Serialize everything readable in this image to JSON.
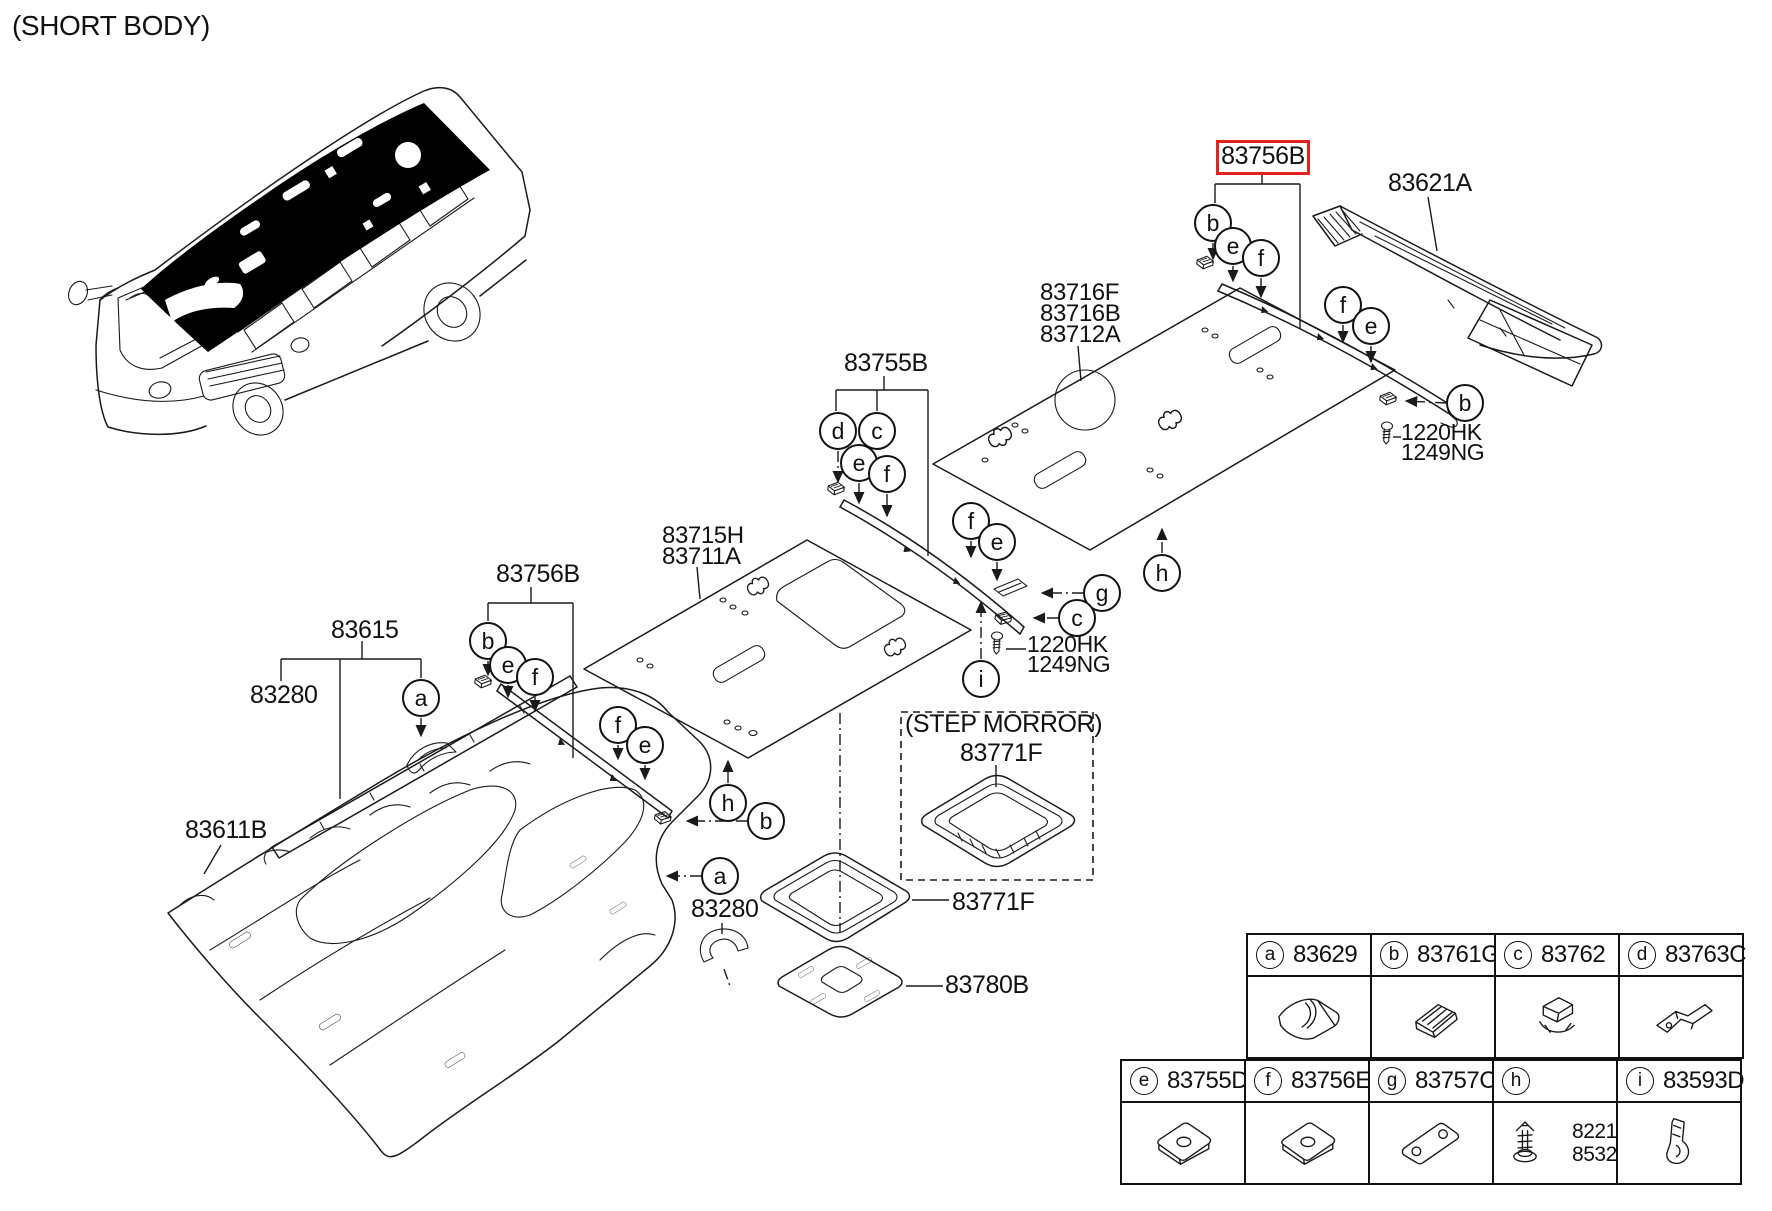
{
  "title": "(SHORT BODY)",
  "colors": {
    "line": "#1a1a1a",
    "highlight": "#e0231c",
    "background": "#ffffff"
  },
  "labels": [
    {
      "name": "label-short-body",
      "text": "(SHORT BODY)",
      "x": 12,
      "y": 12,
      "fs": 28,
      "interactable": false
    },
    {
      "name": "part-label-83756b-highlighted",
      "text": "83756B",
      "x": 1216,
      "y": 140,
      "w": 88,
      "variant": "boxed",
      "interactable": true
    },
    {
      "name": "part-label-83621a",
      "text": "83621A",
      "x": 1388,
      "y": 171,
      "interactable": true
    },
    {
      "name": "part-label-83716f-83716b-83712a",
      "text": "83716F\n83716B\n83712A",
      "x": 1040,
      "y": 282,
      "fs": 24,
      "lh": 21,
      "interactable": true
    },
    {
      "name": "part-label-83755b",
      "text": "83755B",
      "x": 844,
      "y": 351,
      "interactable": true
    },
    {
      "name": "part-label-1220hk-1249ng-right",
      "text": "1220HK\n1249NG",
      "x": 1401,
      "y": 422,
      "fs": 23,
      "lh": 20,
      "interactable": true
    },
    {
      "name": "part-label-83715h-83711a",
      "text": "83715H\n83711A",
      "x": 662,
      "y": 525,
      "fs": 24,
      "lh": 21,
      "interactable": true
    },
    {
      "name": "part-label-83756b-left",
      "text": "83756B",
      "x": 496,
      "y": 562,
      "interactable": true
    },
    {
      "name": "part-label-83615",
      "text": "83615",
      "x": 331,
      "y": 618,
      "interactable": true
    },
    {
      "name": "part-label-83280-front",
      "text": "83280",
      "x": 250,
      "y": 683,
      "interactable": true
    },
    {
      "name": "part-label-1220hk-1249ng-center",
      "text": "1220HK\n1249NG",
      "x": 1027,
      "y": 634,
      "fs": 23,
      "lh": 20,
      "interactable": true
    },
    {
      "name": "label-step-morror",
      "text": "(STEP MORROR)",
      "x": 905,
      "y": 712,
      "interactable": false
    },
    {
      "name": "part-label-83771f-step",
      "text": "83771F",
      "x": 960,
      "y": 741,
      "interactable": true
    },
    {
      "name": "part-label-83611b",
      "text": "83611B",
      "x": 185,
      "y": 818,
      "interactable": true
    },
    {
      "name": "part-label-83771f",
      "text": "83771F",
      "x": 952,
      "y": 890,
      "interactable": true
    },
    {
      "name": "part-label-83280-center",
      "text": "83280",
      "x": 691,
      "y": 897,
      "interactable": true
    },
    {
      "name": "part-label-83780b",
      "text": "83780B",
      "x": 945,
      "y": 973,
      "interactable": true
    }
  ],
  "callouts": [
    {
      "letter": "b",
      "x": 1213,
      "y": 223
    },
    {
      "letter": "e",
      "x": 1233,
      "y": 246
    },
    {
      "letter": "f",
      "x": 1261,
      "y": 258
    },
    {
      "letter": "f",
      "x": 1343,
      "y": 305
    },
    {
      "letter": "e",
      "x": 1371,
      "y": 326
    },
    {
      "letter": "b",
      "x": 1465,
      "y": 403
    },
    {
      "letter": "d",
      "x": 838,
      "y": 431
    },
    {
      "letter": "c",
      "x": 877,
      "y": 431
    },
    {
      "letter": "e",
      "x": 859,
      "y": 463
    },
    {
      "letter": "f",
      "x": 887,
      "y": 474
    },
    {
      "letter": "f",
      "x": 971,
      "y": 521
    },
    {
      "letter": "e",
      "x": 997,
      "y": 542
    },
    {
      "letter": "g",
      "x": 1102,
      "y": 593
    },
    {
      "letter": "c",
      "x": 1077,
      "y": 618
    },
    {
      "letter": "i",
      "x": 981,
      "y": 679
    },
    {
      "letter": "h",
      "x": 1162,
      "y": 573
    },
    {
      "letter": "b",
      "x": 488,
      "y": 641
    },
    {
      "letter": "e",
      "x": 508,
      "y": 665
    },
    {
      "letter": "f",
      "x": 535,
      "y": 677
    },
    {
      "letter": "f",
      "x": 618,
      "y": 725
    },
    {
      "letter": "e",
      "x": 645,
      "y": 745
    },
    {
      "letter": "a",
      "x": 421,
      "y": 698
    },
    {
      "letter": "a",
      "x": 720,
      "y": 876
    },
    {
      "letter": "h",
      "x": 728,
      "y": 803
    },
    {
      "letter": "b",
      "x": 766,
      "y": 821
    }
  ],
  "legend": {
    "cell_w": 126,
    "cell_h": 126,
    "rows": [
      {
        "x": 1246,
        "y": 933,
        "items": [
          {
            "letter": "a",
            "part": "83629",
            "icon": "roll-pad"
          },
          {
            "letter": "b",
            "part": "83761G",
            "icon": "ribbed-clip"
          },
          {
            "letter": "c",
            "part": "83762",
            "icon": "claw-clip"
          },
          {
            "letter": "d",
            "part": "83763C",
            "icon": "angle-bracket"
          }
        ]
      },
      {
        "x": 1120,
        "y": 1059,
        "items": [
          {
            "letter": "e",
            "part": "83755D",
            "icon": "square-pad"
          },
          {
            "letter": "f",
            "part": "83756E",
            "icon": "square-pad"
          },
          {
            "letter": "g",
            "part": "83757C",
            "icon": "plate-two-holes"
          },
          {
            "letter": "h",
            "part": "",
            "icon": "push-rivet",
            "extra": [
              "82212",
              "85326"
            ]
          },
          {
            "letter": "i",
            "part": "83593D",
            "icon": "stand-clip"
          }
        ]
      }
    ]
  }
}
